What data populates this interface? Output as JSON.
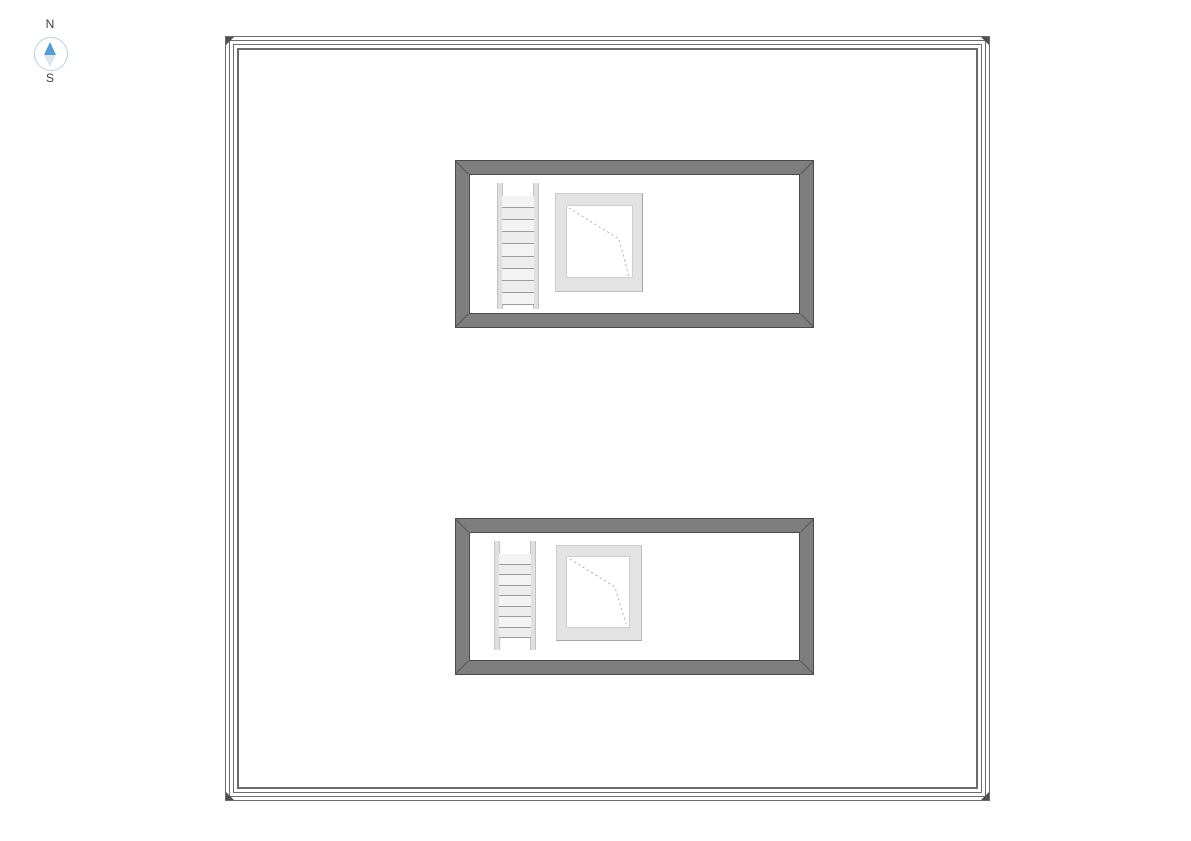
{
  "canvas": {
    "background": "#ffffff",
    "width": 1191,
    "height": 841
  },
  "compass": {
    "north_label": "N",
    "south_label": "S",
    "ring_color": "#b7cfe0",
    "north_needle_color": "#539bd5",
    "south_needle_color": "#dde7ee",
    "label_color": "#3f3f3f"
  },
  "plan": {
    "boundary": {
      "shape": "square",
      "line_color": "#6b6b6b",
      "line_count": 4,
      "corner_marker_color": "#4f4f4f"
    },
    "wall": {
      "fill_color": "#7e7e7e",
      "edge_color": "#4a4a4a",
      "miter_line_color": "#555555"
    },
    "ladder": {
      "rail_color": "#e0e0e0",
      "rung_fill_color": "#ededed",
      "rung_line_color": "#9c9c9c"
    },
    "roof_hatch": {
      "frame_color": "#e3e3e3",
      "opening_color": "#ffffff",
      "swing_line_color": "#b0b0b0",
      "swing_line_style": "dashed"
    },
    "rooms": [
      {
        "id": "upper-room",
        "objects": [
          {
            "type": "ladder",
            "rungs": 9
          },
          {
            "type": "roof-hatch",
            "swing_points": "2,2 52,33 62,71"
          }
        ]
      },
      {
        "id": "lower-room",
        "objects": [
          {
            "type": "ladder",
            "rungs": 8
          },
          {
            "type": "roof-hatch",
            "swing_points": "3,2 48,30 59,67"
          }
        ]
      }
    ]
  }
}
